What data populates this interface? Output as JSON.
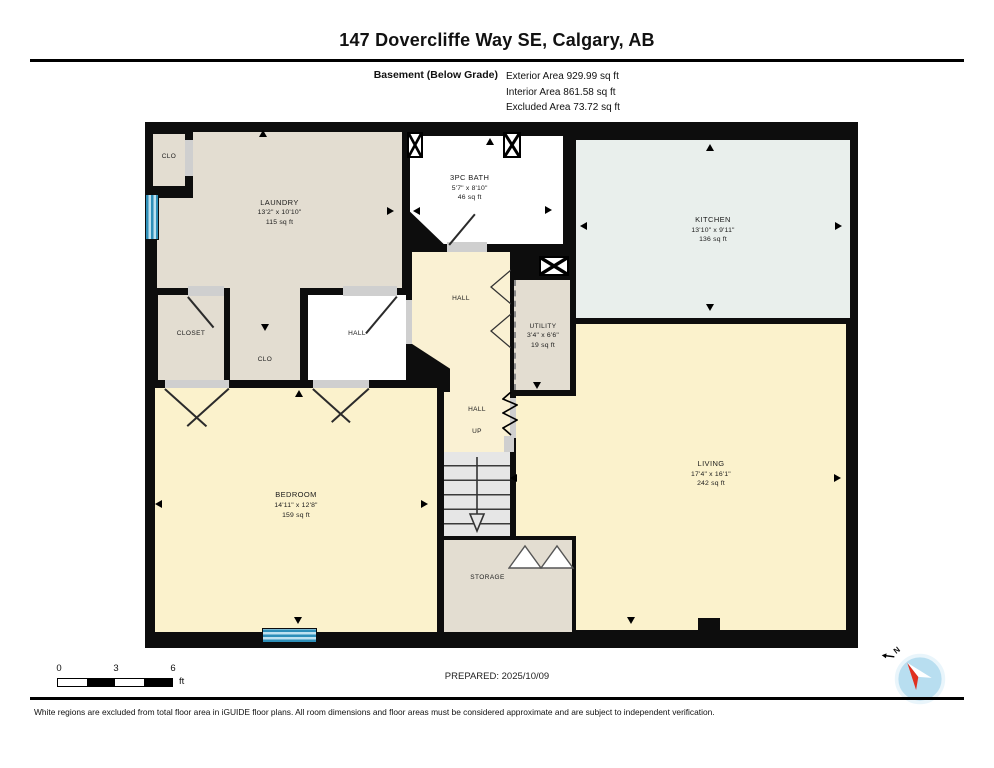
{
  "title": "147 Dovercliffe Way SE, Calgary, AB",
  "floor_info": {
    "floor_label": "Basement (Below Grade)",
    "exterior_area": "Exterior Area 929.99 sq ft",
    "interior_area": "Interior Area 861.58 sq ft",
    "excluded_area": "Excluded Area 73.72 sq ft"
  },
  "rooms": {
    "clo_upper": {
      "name": "CLO"
    },
    "laundry": {
      "name": "LAUNDRY",
      "dims": "13'2\" x 10'10\"",
      "area": "115 sq ft"
    },
    "bath": {
      "name": "3PC BATH",
      "dims": "5'7\" x 8'10\"",
      "area": "46 sq ft"
    },
    "kitchen": {
      "name": "KITCHEN",
      "dims": "13'10\" x 9'11\"",
      "area": "136 sq ft"
    },
    "closet": {
      "name": "CLOSET"
    },
    "clo_lower": {
      "name": "CLO"
    },
    "hall_west": {
      "name": "HALL"
    },
    "hall_mid": {
      "name": "HALL"
    },
    "utility": {
      "name": "UTILITY",
      "dims": "3'4\" x 6'6\"",
      "area": "19 sq ft"
    },
    "bedroom": {
      "name": "BEDROOM",
      "dims": "14'11\" x 12'8\"",
      "area": "159 sq ft"
    },
    "hall_stairs": {
      "name": "HALL",
      "up_label": "UP"
    },
    "storage": {
      "name": "STORAGE"
    },
    "living": {
      "name": "LIVING",
      "dims": "17'4\" x 16'1\"",
      "area": "242 sq ft"
    }
  },
  "scale_bar": {
    "tick0": "0",
    "tick1": "3",
    "tick2": "6",
    "unit": "ft"
  },
  "prepared": "PREPARED: 2025/10/09",
  "compass": {
    "north_label": "N"
  },
  "disclaimer": "White regions are excluded from total floor area in iGUIDE floor plans. All room dimensions and floor areas must be considered approximate and are subject to independent verification.",
  "colors": {
    "wall": "#0d0d0d",
    "included_room": "#fbf2cc",
    "finished_room": "#e3ddd1",
    "kitchen_room": "#e9efec",
    "excluded_room": "#ffffff",
    "window_blue": "#2e8fb8"
  }
}
